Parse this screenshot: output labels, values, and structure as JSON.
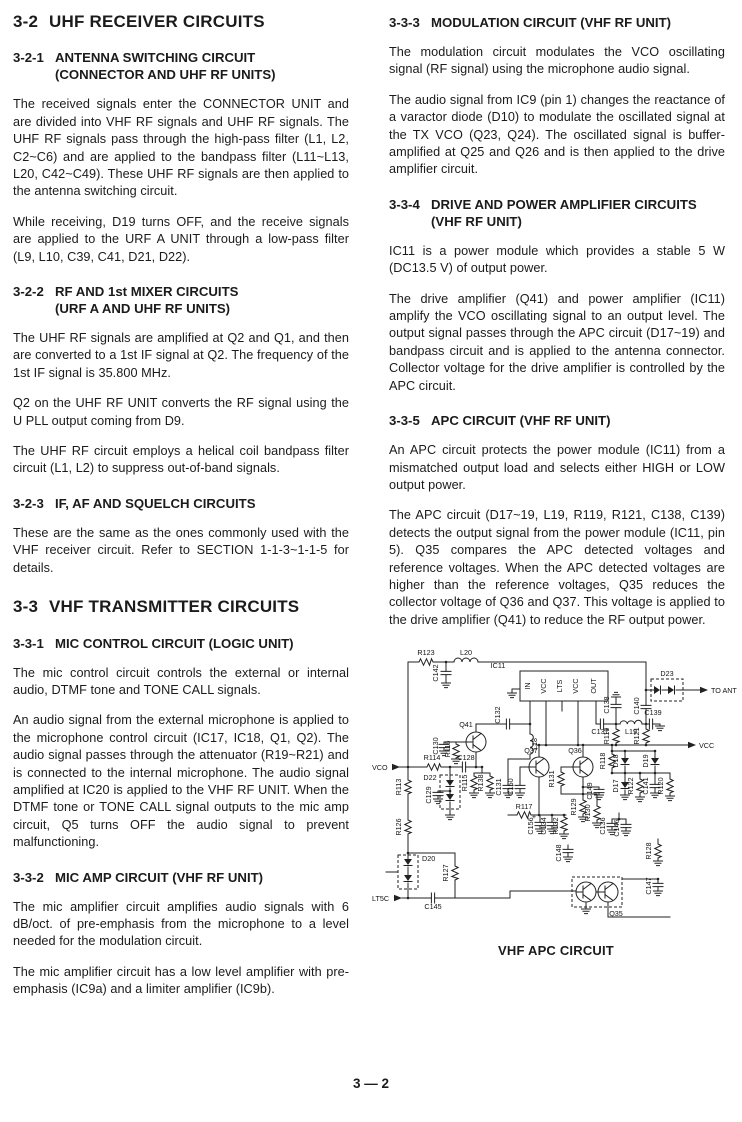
{
  "columns": {
    "left": [
      {
        "t": "h1",
        "num": "3-2",
        "title": "UHF RECEIVER CIRCUITS"
      },
      {
        "t": "sec",
        "num": "3-2-1",
        "title": "ANTENNA SWITCHING CIRCUIT",
        "title2": "(CONNECTOR AND UHF RF UNITS)",
        "paras": [
          "The received signals enter the CONNECTOR UNIT and are divided into VHF RF signals and UHF RF signals. The UHF RF signals pass through the high-pass filter (L1, L2, C2~C6) and are applied to the bandpass filter (L11~L13, L20, C42~C49). These UHF RF signals are then applied to the antenna switching circuit.",
          "While receiving, D19 turns OFF, and the receive signals are applied to the URF A UNIT through a low-pass filter (L9, L10, C39, C41, D21, D22)."
        ]
      },
      {
        "t": "sec",
        "num": "3-2-2",
        "title": "RF AND 1st MIXER CIRCUITS",
        "title2": "(URF A AND UHF RF UNITS)",
        "paras": [
          "The UHF RF signals are amplified at Q2 and Q1, and then are converted to a 1st IF signal at Q2. The frequency of the 1st IF signal is 35.800 MHz.",
          "Q2 on the UHF RF UNIT converts the RF signal using the U PLL output coming from D9.",
          "The UHF RF circuit employs a helical coil bandpass filter circuit (L1, L2) to suppress out-of-band signals."
        ]
      },
      {
        "t": "sec",
        "num": "3-2-3",
        "title": "IF, AF AND SQUELCH CIRCUITS",
        "paras": [
          "These are the same as the ones commonly used with the VHF receiver circuit. Refer to SECTION 1-1-3~1-1-5 for details."
        ]
      },
      {
        "t": "h1",
        "num": "3-3",
        "title": "VHF TRANSMITTER CIRCUITS"
      },
      {
        "t": "sec",
        "num": "3-3-1",
        "title": "MIC CONTROL CIRCUIT (LOGIC UNIT)",
        "paras": [
          "The mic control circuit controls the external or internal audio, DTMF tone and TONE CALL signals.",
          "An audio signal from the external microphone is applied to the microphone control circuit (IC17, IC18, Q1, Q2). The audio signal passes through the attenuator (R19~R21) and is connected to the internal microphone. The audio signal amplified at IC20 is applied to the VHF RF UNIT. When the DTMF tone or TONE CALL signal outputs to the mic amp circuit, Q5 turns OFF the audio signal to prevent malfunctioning."
        ]
      },
      {
        "t": "sec",
        "num": "3-3-2",
        "title": "MIC AMP CIRCUIT (VHF RF UNIT)",
        "paras": [
          "The mic amplifier circuit amplifies audio signals with 6 dB/oct. of pre-emphasis from the microphone to a level needed for the modulation circuit.",
          "The mic amplifier circuit has a low level amplifier with pre-emphasis (IC9a) and a limiter amplifier (IC9b)."
        ]
      }
    ],
    "right": [
      {
        "t": "sec",
        "num": "3-3-3",
        "title": "MODULATION CIRCUIT (VHF RF UNIT)",
        "paras": [
          "The modulation circuit modulates the VCO oscillating signal (RF signal) using the microphone audio signal.",
          "The audio signal from IC9 (pin 1) changes the reactance of a varactor diode (D10) to modulate the oscillated signal at the TX VCO (Q23, Q24). The oscillated signal is buffer-amplified at Q25 and Q26 and is then applied to the drive amplifier circuit."
        ]
      },
      {
        "t": "sec",
        "num": "3-3-4",
        "title": "DRIVE AND POWER AMPLIFIER CIRCUITS",
        "title2": "(VHF RF UNIT)",
        "paras": [
          "IC11 is a power module which provides a stable 5 W (DC13.5 V) of output power.",
          "The drive amplifier (Q41) and power amplifier (IC11) amplify the VCO oscillating signal to an output level. The output signal passes through the APC circuit (D17~19) and bandpass circuit and is applied to the antenna connector. Collector voltage for the drive amplifier is controlled by the APC circuit."
        ]
      },
      {
        "t": "sec",
        "num": "3-3-5",
        "title": "APC CIRCUIT (VHF RF UNIT)",
        "paras": [
          "An APC circuit protects the power module (IC11) from a mismatched output load and selects either HIGH or LOW output power.",
          "The APC circuit (D17~19, L19, R119, R121, C138, C139) detects the output signal from the power module (IC11, pin 5). Q35 compares the APC detected voltages and reference voltages. When the APC detected voltages are higher than the reference voltages, Q35 reduces the collector voltage of Q36 and Q37. This voltage is applied to the drive amplifier (Q41) to reduce the RF output power."
        ]
      }
    ]
  },
  "diagram": {
    "caption": "VHF APC CIRCUIT",
    "labels": [
      {
        "t": "R123",
        "x": 56,
        "y": 16
      },
      {
        "t": "L20",
        "x": 96,
        "y": 16
      },
      {
        "t": "C142",
        "x": 68,
        "y": 34,
        "r": 1
      },
      {
        "t": "IC11",
        "x": 128,
        "y": 29
      },
      {
        "t": "IN",
        "x": 160,
        "y": 47,
        "r": 1
      },
      {
        "t": "VCC",
        "x": 176,
        "y": 47,
        "r": 1
      },
      {
        "t": "LTS",
        "x": 192,
        "y": 47,
        "r": 1
      },
      {
        "t": "VCC",
        "x": 208,
        "y": 47,
        "r": 1
      },
      {
        "t": "OUT",
        "x": 226,
        "y": 47,
        "r": 1
      },
      {
        "t": "Q41",
        "x": 96,
        "y": 88
      },
      {
        "t": "C132",
        "x": 130,
        "y": 76,
        "r": 1
      },
      {
        "t": "L18",
        "x": 167,
        "y": 105,
        "r": 1
      },
      {
        "t": "C130",
        "x": 68,
        "y": 107,
        "r": 1
      },
      {
        "t": "R116",
        "x": 80,
        "y": 110,
        "r": 1
      },
      {
        "t": "R114",
        "x": 62,
        "y": 121
      },
      {
        "t": "C128",
        "x": 96,
        "y": 121
      },
      {
        "t": "VCO",
        "x": 2,
        "y": 131,
        "a": "s"
      },
      {
        "t": "R113",
        "x": 31,
        "y": 148,
        "r": 1
      },
      {
        "t": "D22",
        "x": 60,
        "y": 141
      },
      {
        "t": "C129",
        "x": 61,
        "y": 156,
        "r": 1
      },
      {
        "t": "R115",
        "x": 97,
        "y": 144,
        "r": 1
      },
      {
        "t": "R138",
        "x": 113,
        "y": 144,
        "r": 1
      },
      {
        "t": "C131",
        "x": 131,
        "y": 148,
        "r": 1
      },
      {
        "t": "C150",
        "x": 143,
        "y": 148,
        "r": 1
      },
      {
        "t": "Q37",
        "x": 161,
        "y": 114
      },
      {
        "t": "Q36",
        "x": 205,
        "y": 114
      },
      {
        "t": "R131",
        "x": 184,
        "y": 140,
        "r": 1
      },
      {
        "t": "C149",
        "x": 222,
        "y": 152,
        "r": 1
      },
      {
        "t": "R129",
        "x": 206,
        "y": 168,
        "r": 1
      },
      {
        "t": "R130",
        "x": 220,
        "y": 174,
        "r": 1
      },
      {
        "t": "R117",
        "x": 154,
        "y": 170
      },
      {
        "t": "C156",
        "x": 163,
        "y": 187,
        "r": 1
      },
      {
        "t": "+",
        "x": 164,
        "y": 180
      },
      {
        "t": "C134",
        "x": 176,
        "y": 187,
        "r": 1
      },
      {
        "t": "R132",
        "x": 188,
        "y": 187,
        "r": 1
      },
      {
        "t": "C148",
        "x": 191,
        "y": 214,
        "r": 1
      },
      {
        "t": "C136",
        "x": 235,
        "y": 187,
        "r": 1
      },
      {
        "t": "C146",
        "x": 249,
        "y": 189,
        "r": 1
      },
      {
        "t": "R128",
        "x": 281,
        "y": 212,
        "r": 1
      },
      {
        "t": "C147",
        "x": 281,
        "y": 247,
        "r": 1
      },
      {
        "t": "Q35",
        "x": 246,
        "y": 277
      },
      {
        "t": "R126",
        "x": 31,
        "y": 188,
        "r": 1
      },
      {
        "t": "D20",
        "x": 52,
        "y": 222,
        "a": "s"
      },
      {
        "t": "R127",
        "x": 78,
        "y": 234,
        "r": 1
      },
      {
        "t": "LT5C",
        "x": 2,
        "y": 262,
        "a": "s"
      },
      {
        "t": "C145",
        "x": 63,
        "y": 270
      },
      {
        "t": "R118",
        "x": 235,
        "y": 122,
        "r": 1
      },
      {
        "t": "D18",
        "x": 248,
        "y": 122,
        "r": 1
      },
      {
        "t": "D19",
        "x": 278,
        "y": 122,
        "r": 1
      },
      {
        "t": "D17",
        "x": 248,
        "y": 147,
        "r": 1
      },
      {
        "t": "R122",
        "x": 263,
        "y": 147,
        "r": 1
      },
      {
        "t": "C141",
        "x": 278,
        "y": 147,
        "r": 1
      },
      {
        "t": "R120",
        "x": 293,
        "y": 147,
        "r": 1
      },
      {
        "t": "R119",
        "x": 239,
        "y": 97,
        "r": 1
      },
      {
        "t": "R121",
        "x": 269,
        "y": 97,
        "r": 1
      },
      {
        "t": "C137",
        "x": 230,
        "y": 95
      },
      {
        "t": "L19",
        "x": 261,
        "y": 95
      },
      {
        "t": "C139",
        "x": 283,
        "y": 76
      },
      {
        "t": "C138",
        "x": 239,
        "y": 66,
        "r": 1
      },
      {
        "t": "C140",
        "x": 269,
        "y": 67,
        "r": 1
      },
      {
        "t": "D23",
        "x": 297,
        "y": 37
      },
      {
        "t": "TO ANT",
        "x": 341,
        "y": 54,
        "a": "s"
      },
      {
        "t": "VCC",
        "x": 329,
        "y": 109,
        "a": "s"
      }
    ]
  },
  "footer": {
    "page_number": "3 — 2"
  }
}
